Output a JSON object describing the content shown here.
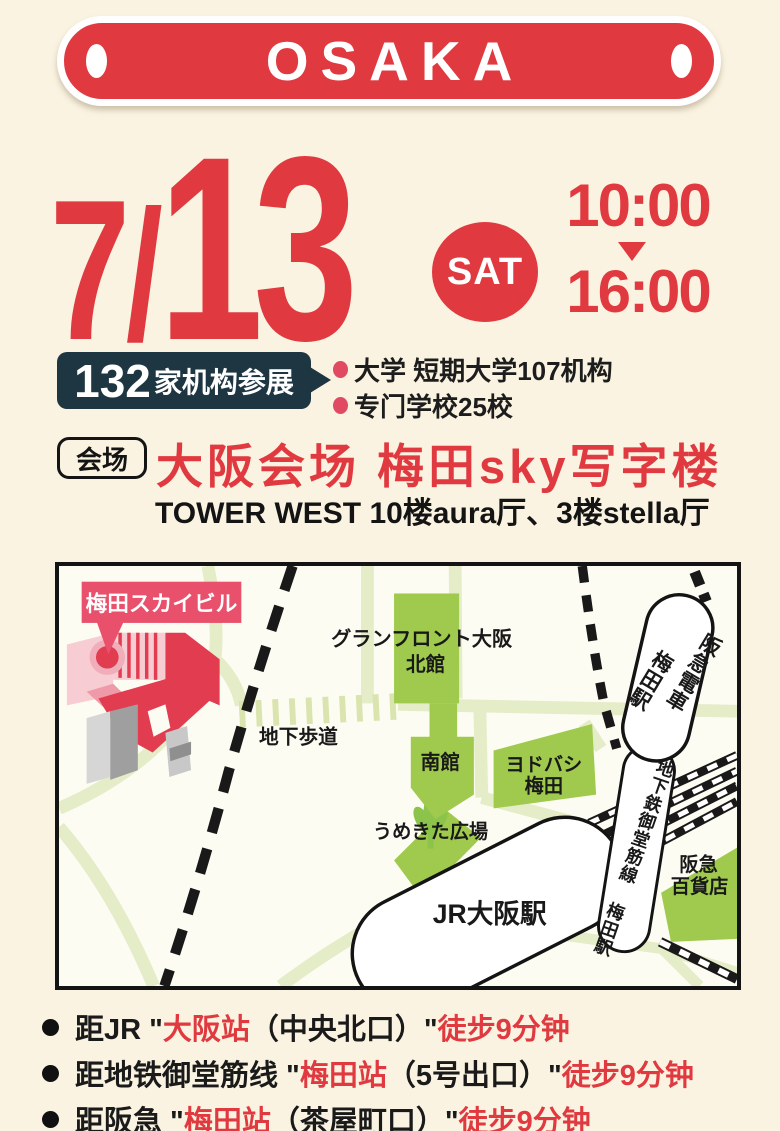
{
  "colors": {
    "page_bg": "#faf3e1",
    "accent_red": "#e03a40",
    "badge_navy": "#1e3642",
    "bullet_pink": "#e04b63",
    "map_building_green": "#9fca4d",
    "map_road_green": "#e5ecc8",
    "sky_label_red": "#e8506b",
    "sky_building_red": "#e23c50"
  },
  "banner": {
    "title": "OSAKA"
  },
  "date": {
    "month": "7",
    "slash": "/",
    "day": "13",
    "weekday": "SAT",
    "time_start": "10:00",
    "time_end": "16:00"
  },
  "stats": {
    "count": "132",
    "count_suffix": "家机构参展",
    "items": [
      {
        "label": "大学 短期大学107机构"
      },
      {
        "label": "专门学校25校"
      }
    ]
  },
  "venue": {
    "badge": "会场",
    "title": "大阪会场 梅田sky写字楼",
    "subtitle": "TOWER WEST 10楼aura厅、3楼stella厅"
  },
  "map": {
    "sky_building_label": "梅田スカイビル",
    "underpass": "地下歩道",
    "grand_front": "グランフロント大阪",
    "north_bldg": "北館",
    "south_bldg": "南館",
    "yodobashi_line1": "ヨドバシ",
    "yodobashi_line2": "梅田",
    "hankyu_line_col1": "阪急電車",
    "hankyu_line_col2": "梅田駅",
    "umekita": "うめきた広場",
    "jr_osaka": "JR大阪駅",
    "subway_line": "地下鉄御堂筋線 梅田駅",
    "hankyu_dept_line1": "阪急",
    "hankyu_dept_line2": "百貨店"
  },
  "access": {
    "items": [
      {
        "lead": "距JR \"",
        "station": "大阪站",
        "exit": "（中央北口）\" ",
        "walk": "徒步9分钟"
      },
      {
        "lead": "距地铁御堂筋线 \"",
        "station": "梅田站",
        "exit": "（5号出口）\" ",
        "walk": "徒步9分钟"
      },
      {
        "lead": "距阪急 \"",
        "station": "梅田站",
        "exit": "（茶屋町口）\" ",
        "walk": "徒步9分钟"
      }
    ]
  }
}
